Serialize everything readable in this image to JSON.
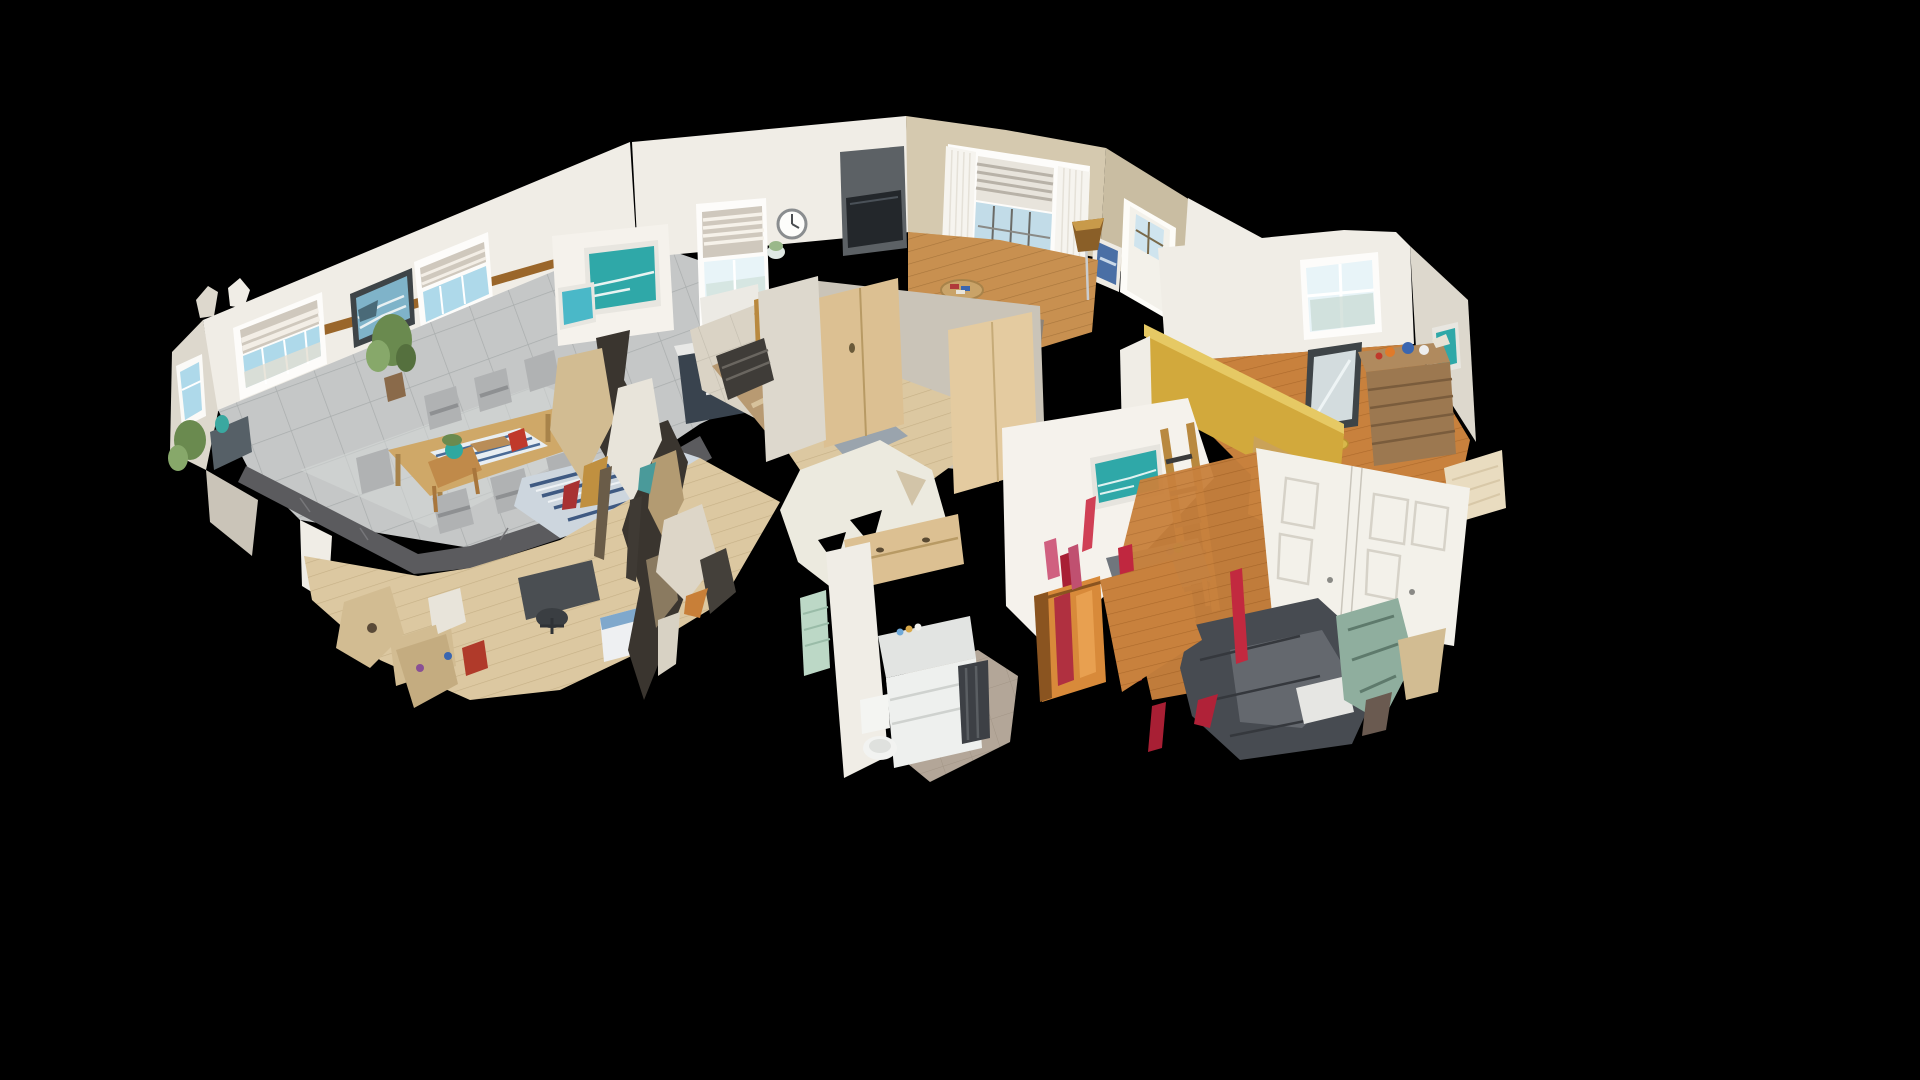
{
  "scene": {
    "view_mode": "dollhouse-3d",
    "background": "#000000",
    "palette": {
      "wall": "#f0ede6",
      "wall_bright": "#f5f2ec",
      "wall_shade": "#ddd8cd",
      "wall_dim": "#cac4b8",
      "wall_tan": "#d5c9af",
      "wall_tan_dark": "#c9bda2",
      "gold_wall": "#d2a93c",
      "gold_wall_light": "#e6c964",
      "tile_floor": "#c5c7c7",
      "kitchen_tile": "#dad3c5",
      "wood_pale": "#dcc8a1",
      "wood_warm": "#c89050",
      "wood_orange": "#c8813d",
      "taupe_floor": "#b3a698",
      "slab_edge": "#5b5b5e",
      "island_navy": "#39434e",
      "cabinet_maple": "#dcc092",
      "accent_wall": "#5c6165",
      "tv_screen": "#23272b",
      "couch": "#8d8378",
      "pillow_blue": "#6f8fb5",
      "bed_charcoal": "#474b51",
      "bed_sheen": "#6e7278",
      "bed_cream": "#e9dcc0",
      "dresser_wood": "#9c7850",
      "dresser_top": "#b08a5e",
      "art_teal": "#2fa8a8",
      "art_ocean": "#7fb3c9",
      "frame_dark": "#3e4447",
      "glass_sky": "#aed9ea",
      "glass_bright": "#e8f4f8",
      "blind_stripe": "#cfc8bd",
      "banister_wood": "#b9893f",
      "beam_brown": "#9a662a",
      "artifact_red": "#c0273f",
      "artifact_red_dark": "#a81f34",
      "artifact_tan": "#d2bc92",
      "artifact_dark": "#3a352f",
      "artifact_sage": "#8fae9e",
      "plant_green": "#6a8a4f",
      "rug_base": "#cdd6de",
      "rug_stripe_blue": "#3f5a82",
      "chair_gray": "#b0b2b3",
      "closet_orange": "#d88a3a",
      "towel_dark": "#3d4045",
      "counter_white": "#eef0ee",
      "door_white": "#f3f1ea",
      "curtain_white": "#f6f4ef",
      "lamp_amber": "#8a5f28",
      "table_wood": "#cfa868",
      "desk_gray": "#70767d"
    },
    "rooms": [
      "living-dining-room",
      "kitchen",
      "den-sitting-room",
      "hallway",
      "center-bedroom",
      "right-bedroom",
      "bathroom",
      "lower-level-office"
    ],
    "objects": [
      "zebra-blind-windows",
      "ocean-painting",
      "dining-table",
      "gray-chairs",
      "sideboard",
      "houseplants",
      "teal-pot-stool",
      "gray-tile-floor",
      "floor-slab-edge",
      "striped-rug",
      "wall-clock",
      "kitchen-window",
      "tv-accent-wall",
      "bookshelf",
      "kitchen-island",
      "stair-banister",
      "bay-window",
      "sheer-curtains",
      "couch",
      "round-table",
      "floor-lamp",
      "front-door",
      "gold-accent-wall",
      "doorway-mirror",
      "wooden-dresser",
      "leaning-mirror",
      "teal-wall-art",
      "bunk-ladder",
      "desk-and-chair",
      "charcoal-bed",
      "white-closet-doors",
      "cream-bed",
      "maple-wardrobes",
      "bathroom-vanity",
      "toilet",
      "dark-towels",
      "orange-closet",
      "scan-mesh-artifacts"
    ]
  }
}
